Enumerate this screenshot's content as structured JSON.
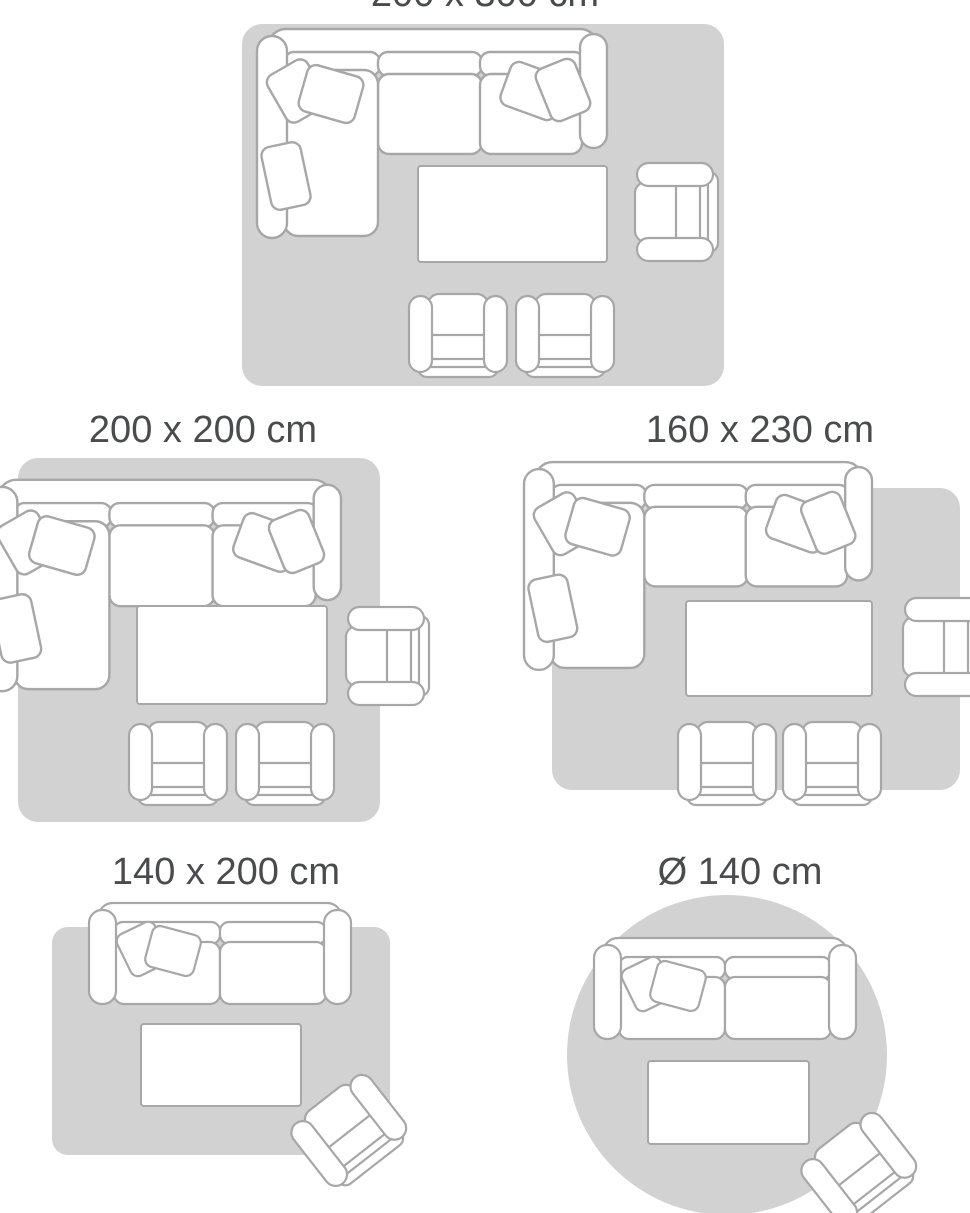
{
  "page": {
    "background_color": "#ffffff",
    "type": "rug-size-guide"
  },
  "style": {
    "rug_color": "#d2d2d2",
    "outline_color": "#a7a7a7",
    "furniture_fill": "#ffffff",
    "label_color": "#4a4b4d"
  },
  "layouts": [
    {
      "id": "rug-200x300",
      "label": "200 x 300 cm",
      "rug_shape": "rectangle"
    },
    {
      "id": "rug-200x200",
      "label": "200 x 200 cm",
      "rug_shape": "rectangle"
    },
    {
      "id": "rug-160x230",
      "label": "160 x 230 cm",
      "rug_shape": "rectangle"
    },
    {
      "id": "rug-140x200",
      "label": "140 x 200 cm",
      "rug_shape": "rectangle"
    },
    {
      "id": "rug-140-round",
      "label": "Ø 140 cm",
      "rug_shape": "circle"
    }
  ]
}
